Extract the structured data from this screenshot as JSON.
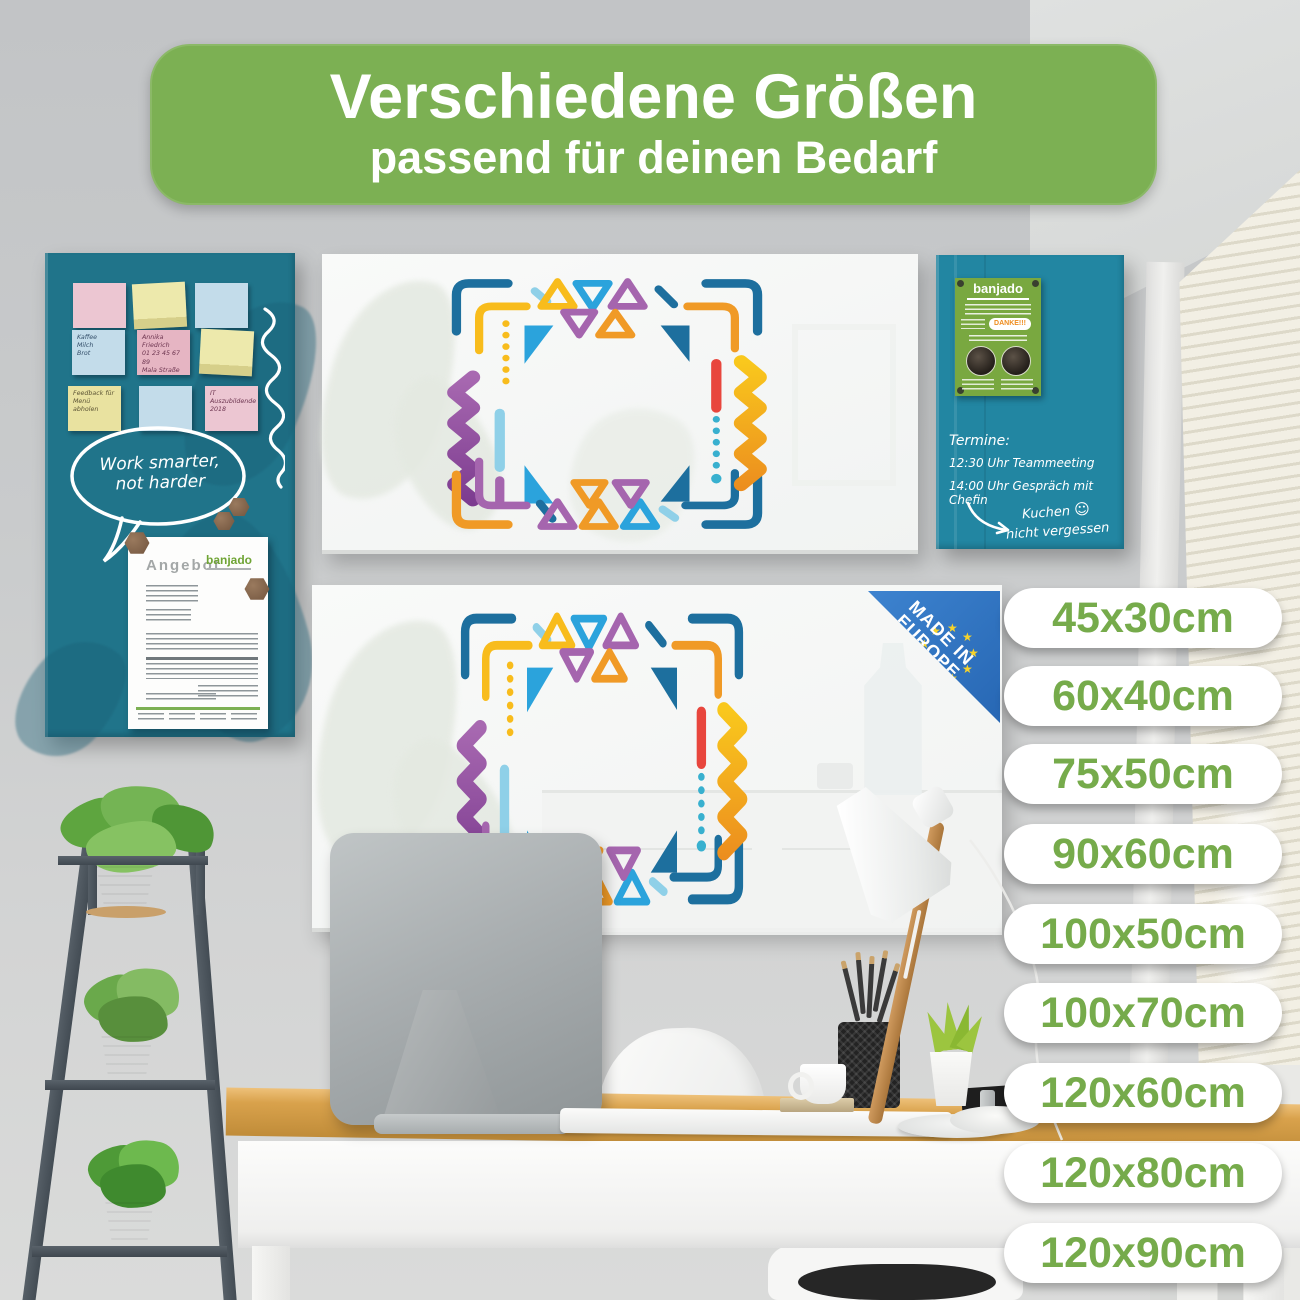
{
  "banner": {
    "title": "Verschiedene Größen",
    "subtitle": "passend für deinen Bedarf"
  },
  "sizes": [
    "45x30cm",
    "60x40cm",
    "75x50cm",
    "90x60cm",
    "100x50cm",
    "100x70cm",
    "120x60cm",
    "120x80cm",
    "120x90cm"
  ],
  "left_board": {
    "note_shopping": [
      "Kaffee",
      "Milch",
      "Brot"
    ],
    "note_contact": [
      "Annika Friedrich",
      "01 23 45 67 89",
      "Mala Straße 76",
      "01234 Freiburg"
    ],
    "note_feedback": [
      "Feedback für",
      "Menü",
      "abholen"
    ],
    "note_it": [
      "IT Auszubildende",
      "2018"
    ],
    "speech_line1": "Work smarter,",
    "speech_line2": "not harder",
    "document": {
      "title": "Angebot",
      "brand": "banjado"
    }
  },
  "right_board": {
    "flyer": {
      "brand": "banjado",
      "danke": "DANKE!!!"
    },
    "schedule_title": "Termine:",
    "schedule_line1": "12:30 Uhr Teammeeting",
    "schedule_line2": "14:00 Uhr Gespräch mit Chefin",
    "reminder_line1": "Kuchen",
    "reminder_line2": "nicht vergessen",
    "smiley": "☺"
  },
  "badge": {
    "line1": "MADE IN",
    "line2": "EUROPE"
  },
  "colors": {
    "banner_green": "#7cb053",
    "pill_text_green": "#76ab4b",
    "board_teal_left": "#20748a",
    "board_teal_right": "#2286a2",
    "flyer_green": "#79a840",
    "badge_blue": "#2e72bf",
    "star_yellow": "#f7d32b",
    "frame_navy": "#1d6f9e",
    "frame_blue": "#2ba3dc",
    "frame_yellow": "#f8bc1c",
    "frame_orange": "#f09a26",
    "frame_purple": "#a565ae",
    "frame_red": "#e8463d",
    "desk_wood": "#d9a24c"
  }
}
